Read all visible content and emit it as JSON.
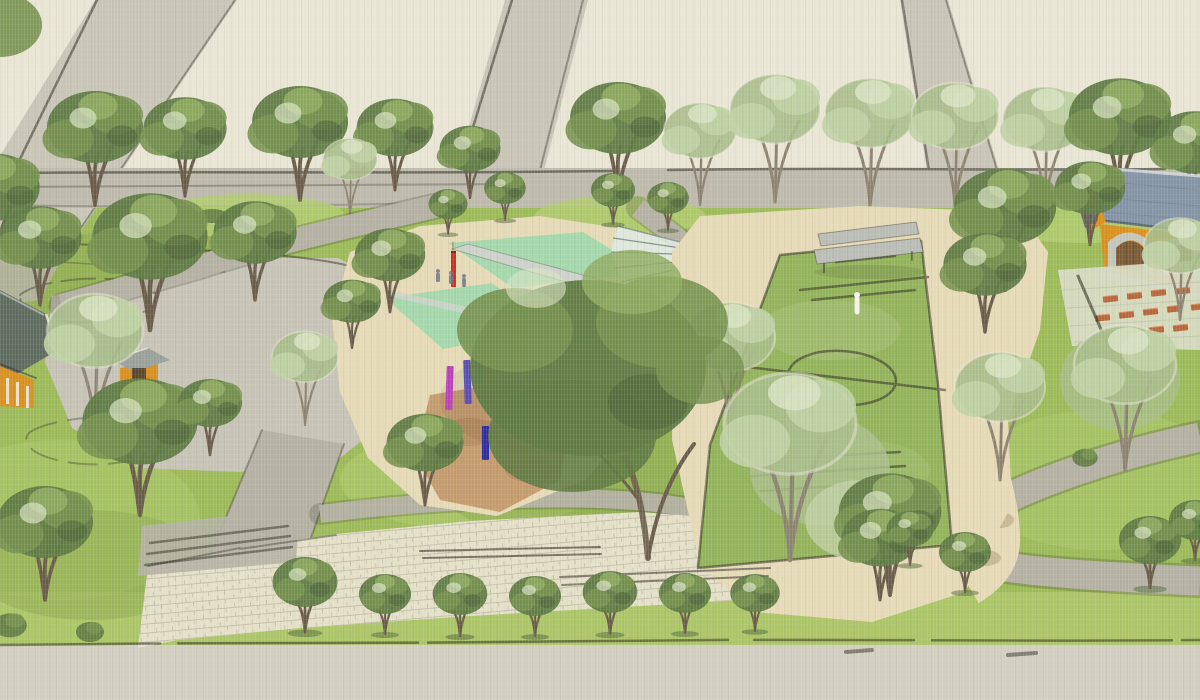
{
  "title": "Watercolor landscape master-plan rendering of a neighborhood park",
  "palette": {
    "paper": "#e9e5d4",
    "road": "#c8c5b7",
    "road2": "#bdbaac",
    "street": "#d2cfc0",
    "path": "#b4b1a3",
    "plaza": "#c6c3b6",
    "paving": "#e4e0c8",
    "paving-line": "#b5b09a",
    "sand": "#e5d9b6",
    "mulch": "#c49b6d",
    "grass": "#9cba58",
    "grass-light": "#b2cb6e",
    "grass-dark": "#87a34b",
    "pitch": "#92b35a",
    "tree-dark": "#5f7a43",
    "tree-mid": "#75914f",
    "tree-light": "#8fab61",
    "tree-pale": "#a9bd8a",
    "tree-pale2": "#c0d0a4",
    "tree-highlight": "#d8e2c2",
    "trunk": "#695c49",
    "trunk-light": "#8d8371",
    "mint": "#a4d8ac",
    "canopy": "#ccd2c9",
    "pole-red": "#c63326",
    "pole-magenta": "#bb3fbb",
    "pole-violet": "#5a4cb0",
    "pole-teal": "#27b0b4",
    "pole-blue": "#2d2d9e",
    "pole-green": "#3f8f46",
    "glass": "#dde8df",
    "glass-rib": "#6b7b6e",
    "roof": "#8494a5",
    "roof-edge": "#4e5a68",
    "wall": "#d9901f",
    "door": "#7c5a36",
    "stone": "#c3c6bc",
    "bench": "#b9bdb5",
    "bench-red": "#b5663a",
    "house-roof": "#5f6b5f",
    "figure": "#f4f3ea",
    "ink": "#2f2b20"
  },
  "scene": {
    "style": "hand-drawn watercolor site rendering, bird's-eye perspective, no text labels",
    "features": [
      {
        "id": "diagonal-roads",
        "label": "Three diagonal gray roads converging toward the top edge",
        "count": 3
      },
      {
        "id": "boulevard",
        "label": "Tree-lined boulevard road crossing the full width"
      },
      {
        "id": "left-plaza",
        "label": "Gray paved plaza on the left with small orange kiosk"
      },
      {
        "id": "cottage",
        "label": "Gabled cottage with dark roof and orange wall at the left edge"
      },
      {
        "id": "playground",
        "label": "Playground with mint shade decks, tilted gray canopy and colored play poles"
      },
      {
        "id": "pole-colors",
        "label": "Playground pole colors",
        "values": [
          "red",
          "magenta",
          "violet",
          "teal",
          "blue",
          "green"
        ]
      },
      {
        "id": "glass-fans",
        "label": "Two folded glass fan pavilions with radiating ribs"
      },
      {
        "id": "soccer-field",
        "label": "Sketched soccer pitch with center circle, boxes and a tiny white figure"
      },
      {
        "id": "grandstand-bench",
        "label": "Long gray bench at the head of the pitch"
      },
      {
        "id": "pavilion",
        "label": "Blue-roofed pavilion with orange walls and two arched doorways at right edge"
      },
      {
        "id": "seating-terrace",
        "label": "Pale paved terrace with rows of red-brown benches",
        "bench_count": 13
      },
      {
        "id": "walkway",
        "label": "Cream stone walkway with brick hatching and steps"
      },
      {
        "id": "bottom-tree-row",
        "label": "Row of round street trees on the bottom lawn",
        "count": 7
      },
      {
        "id": "street",
        "label": "Wide light-gray street across the bottom"
      }
    ]
  }
}
